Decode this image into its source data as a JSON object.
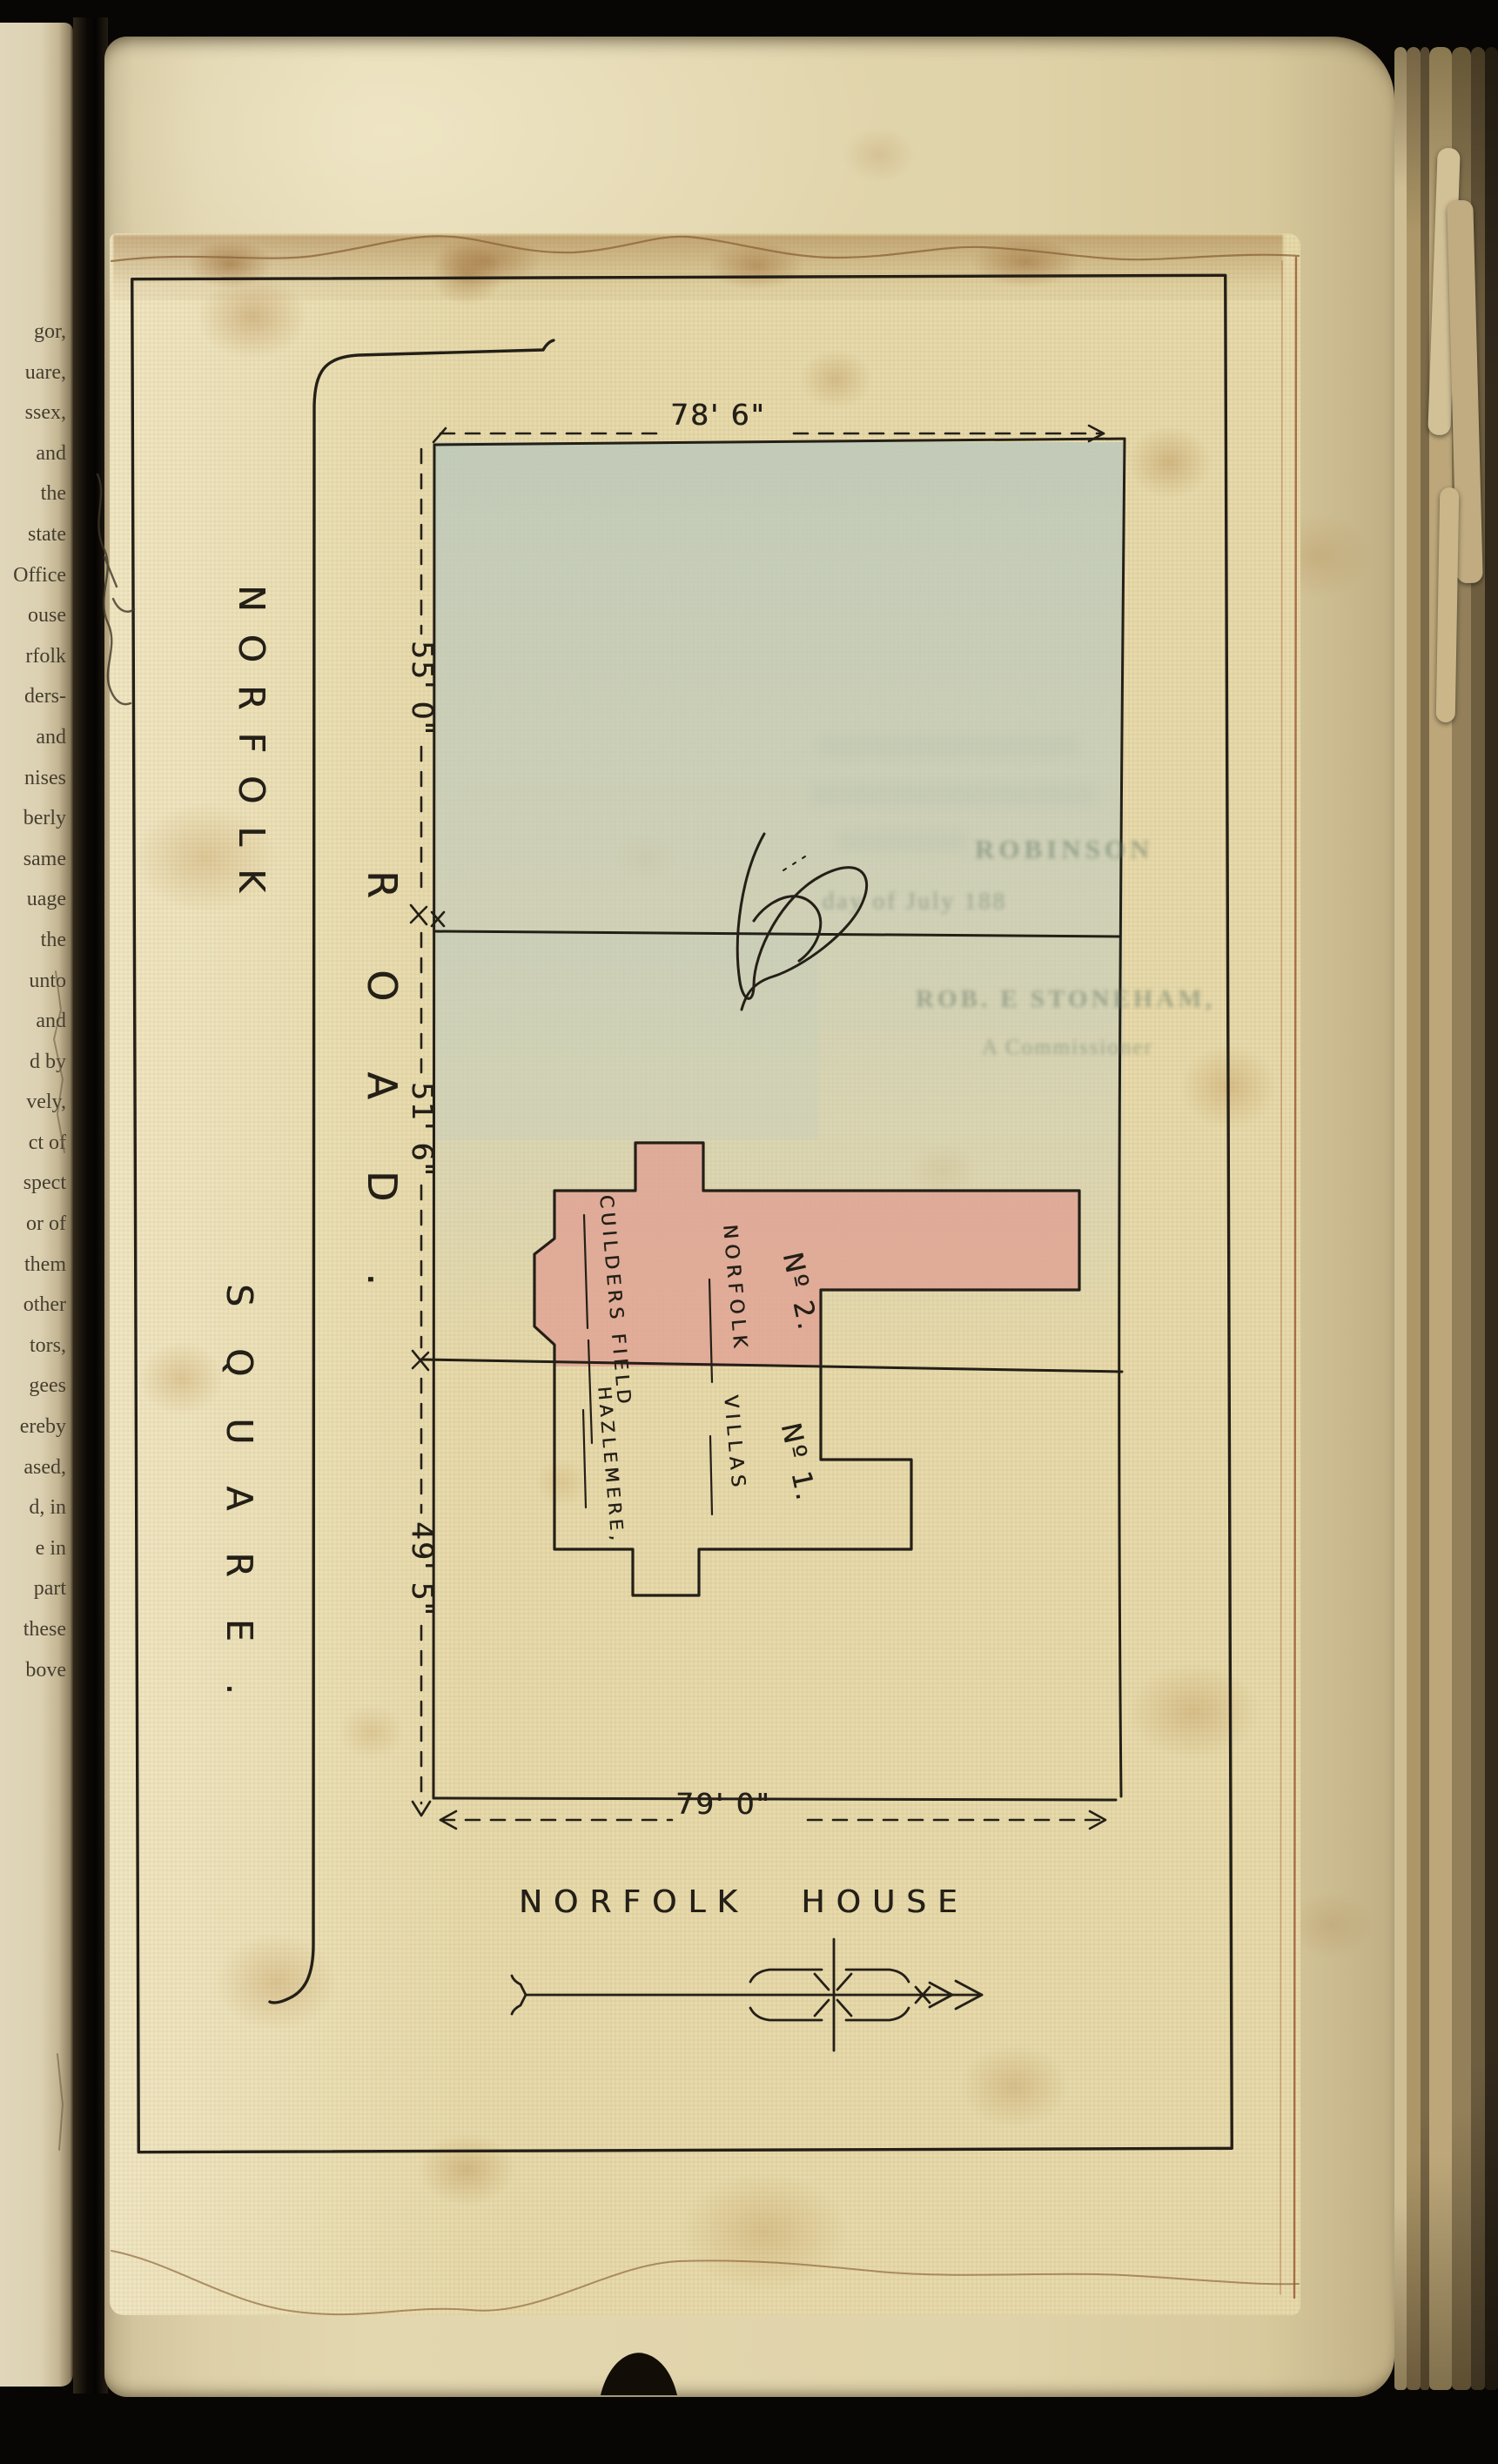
{
  "book": {
    "left_page_fragments": [
      "gor,",
      "uare,",
      "ssex,",
      "and",
      "the",
      "state",
      "Office",
      "ouse",
      "rfolk",
      "ders-",
      "and",
      "nises",
      "berly",
      "same",
      "uage",
      "the",
      "unto",
      "and",
      "d by",
      "vely,",
      "ct of",
      "spect",
      "or of",
      "them",
      "other",
      "tors,",
      "gees",
      "ereby",
      "ased,",
      "d, in",
      "e in",
      "part",
      "these",
      "bove"
    ]
  },
  "plan": {
    "streets": {
      "norfolk": "NORFOLK",
      "road": "ROAD.",
      "square": "SQUARE."
    },
    "dimensions": {
      "top": "78' 6\"",
      "side_upper": "55' 0\"",
      "side_middle": "51' 6\"",
      "side_lower": "49' 5\"",
      "bottom": "79' 0\""
    },
    "buildings": {
      "field_label": "CUILDERS FIELD",
      "villa2_number": "Nº 2.",
      "villa_name_upper": "NORFOLK",
      "villa_name_lower": "VILLAS",
      "villa1_number": "Nº 1.",
      "villa1_name": "HAZLEMERE,"
    },
    "title": "NORFOLK HOUSE",
    "ghost_text": {
      "line1": "ROBINSON",
      "line2": "day of July 188",
      "line3": "ROB. E STONEHAM,",
      "line4": "A Commissioner"
    },
    "colors": {
      "ink": "#241f17",
      "plot_wash": "#c3ccbf",
      "villa_wash": "#e0a193",
      "page": "#e0d3a9",
      "cloth": "#e7daab"
    }
  }
}
